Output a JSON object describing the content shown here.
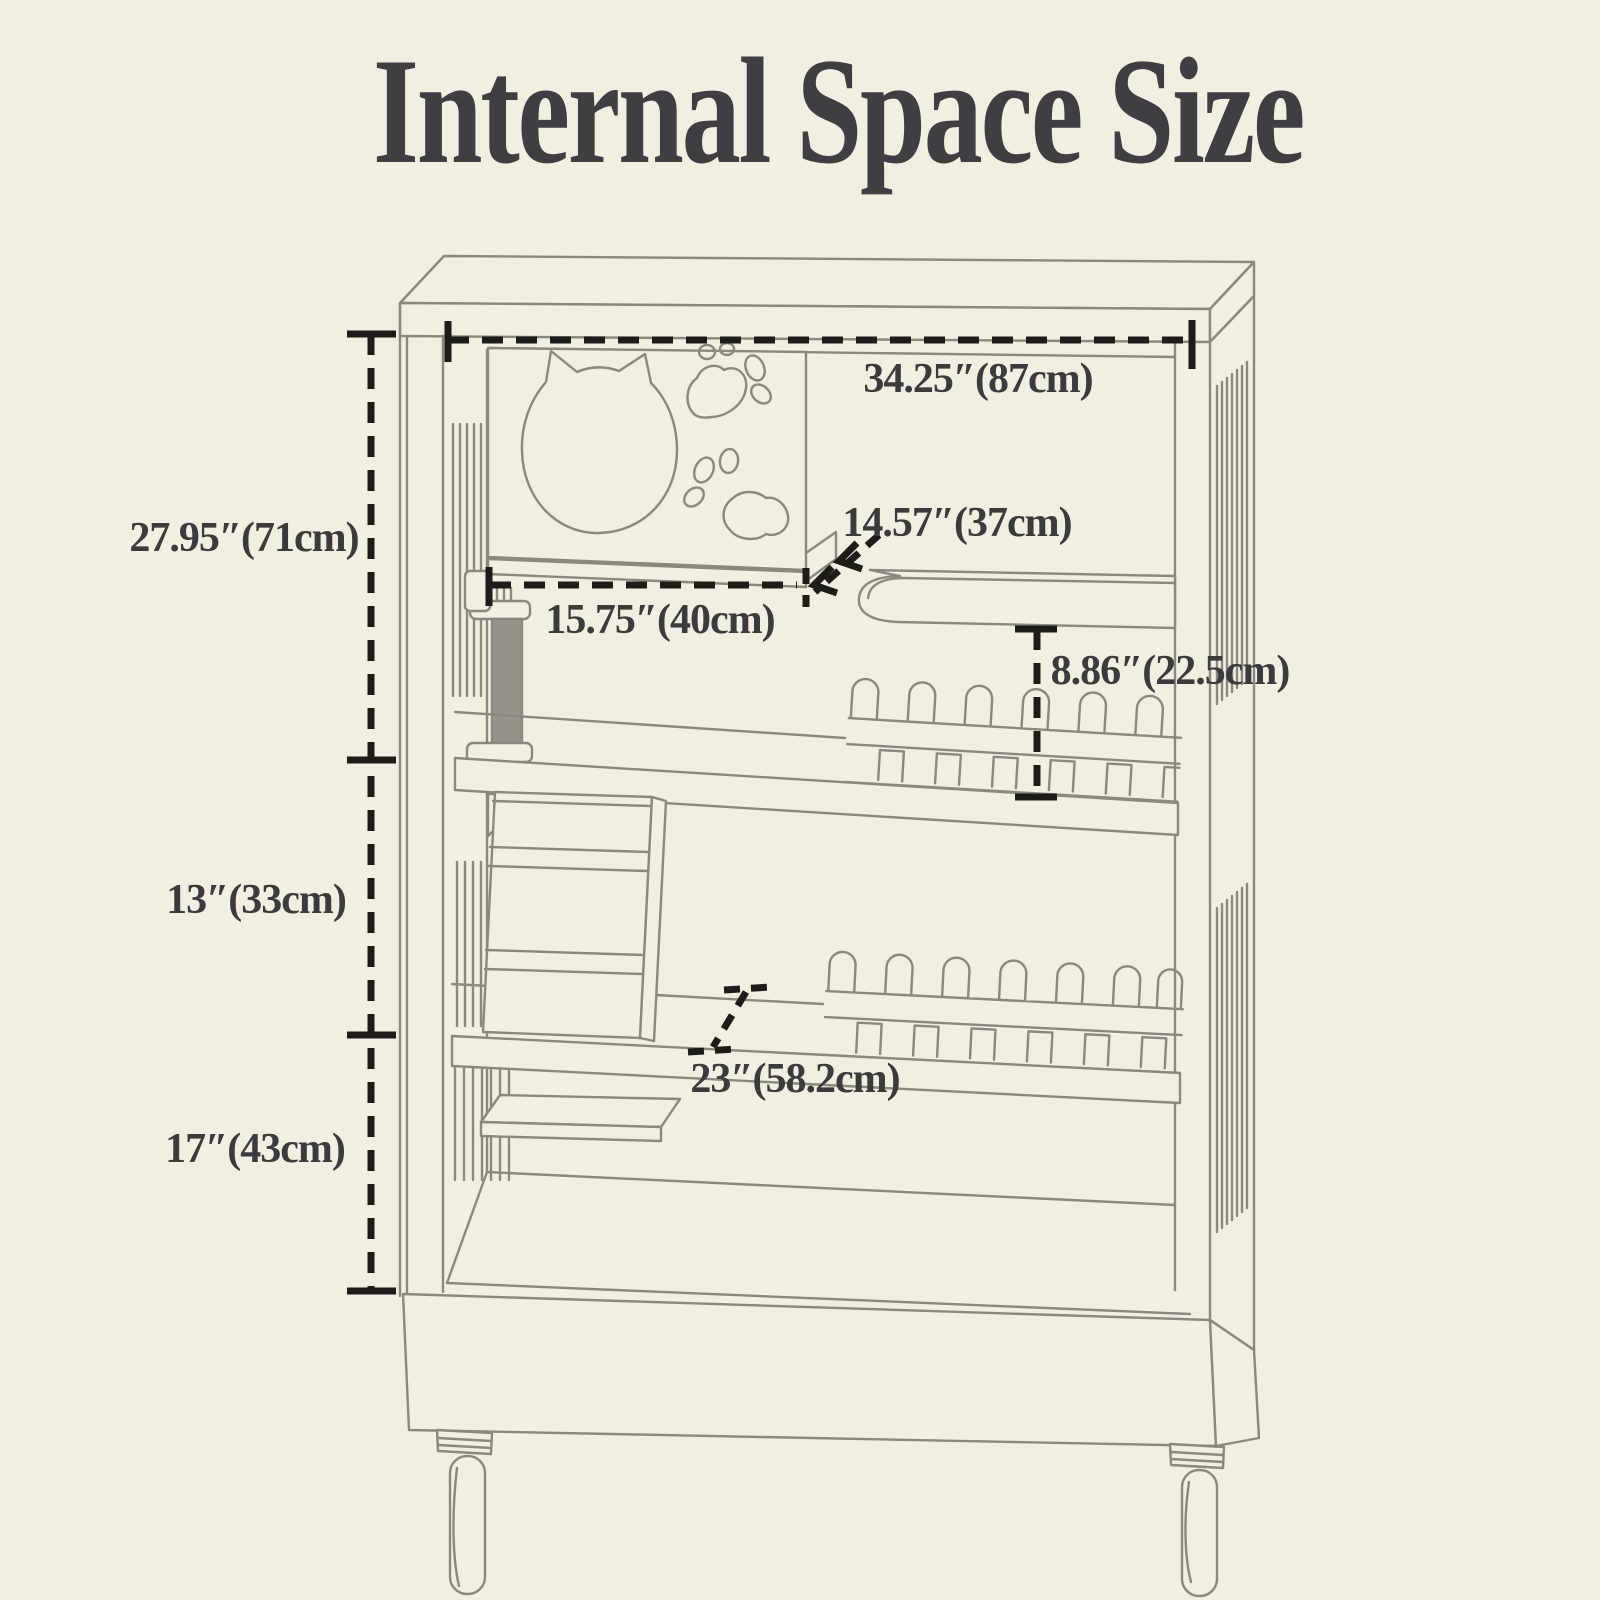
{
  "title": "Internal Space Size",
  "figure": "cat-cage-internal-dimension-diagram",
  "colors": {
    "background": "#f2eee2",
    "artwork_line": "#8b887f",
    "dimension_line": "#1d1c19",
    "label_text": "#3b3a3d",
    "title_text": "#403e43",
    "scratching_post_fill": "#96938c"
  },
  "measurements": {
    "top_width": "34.25″(87cm)",
    "upper_section_height": "27.95″(71cm)",
    "shelf_diagonal": "14.57″(37cm)",
    "shelf_width": "15.75″(40cm)",
    "fence_height": "8.86″(22.5cm)",
    "middle_section_height": "13″(33cm)",
    "bottom_section_height": "17″(43cm)",
    "base_depth": "23″(58.2cm)"
  }
}
